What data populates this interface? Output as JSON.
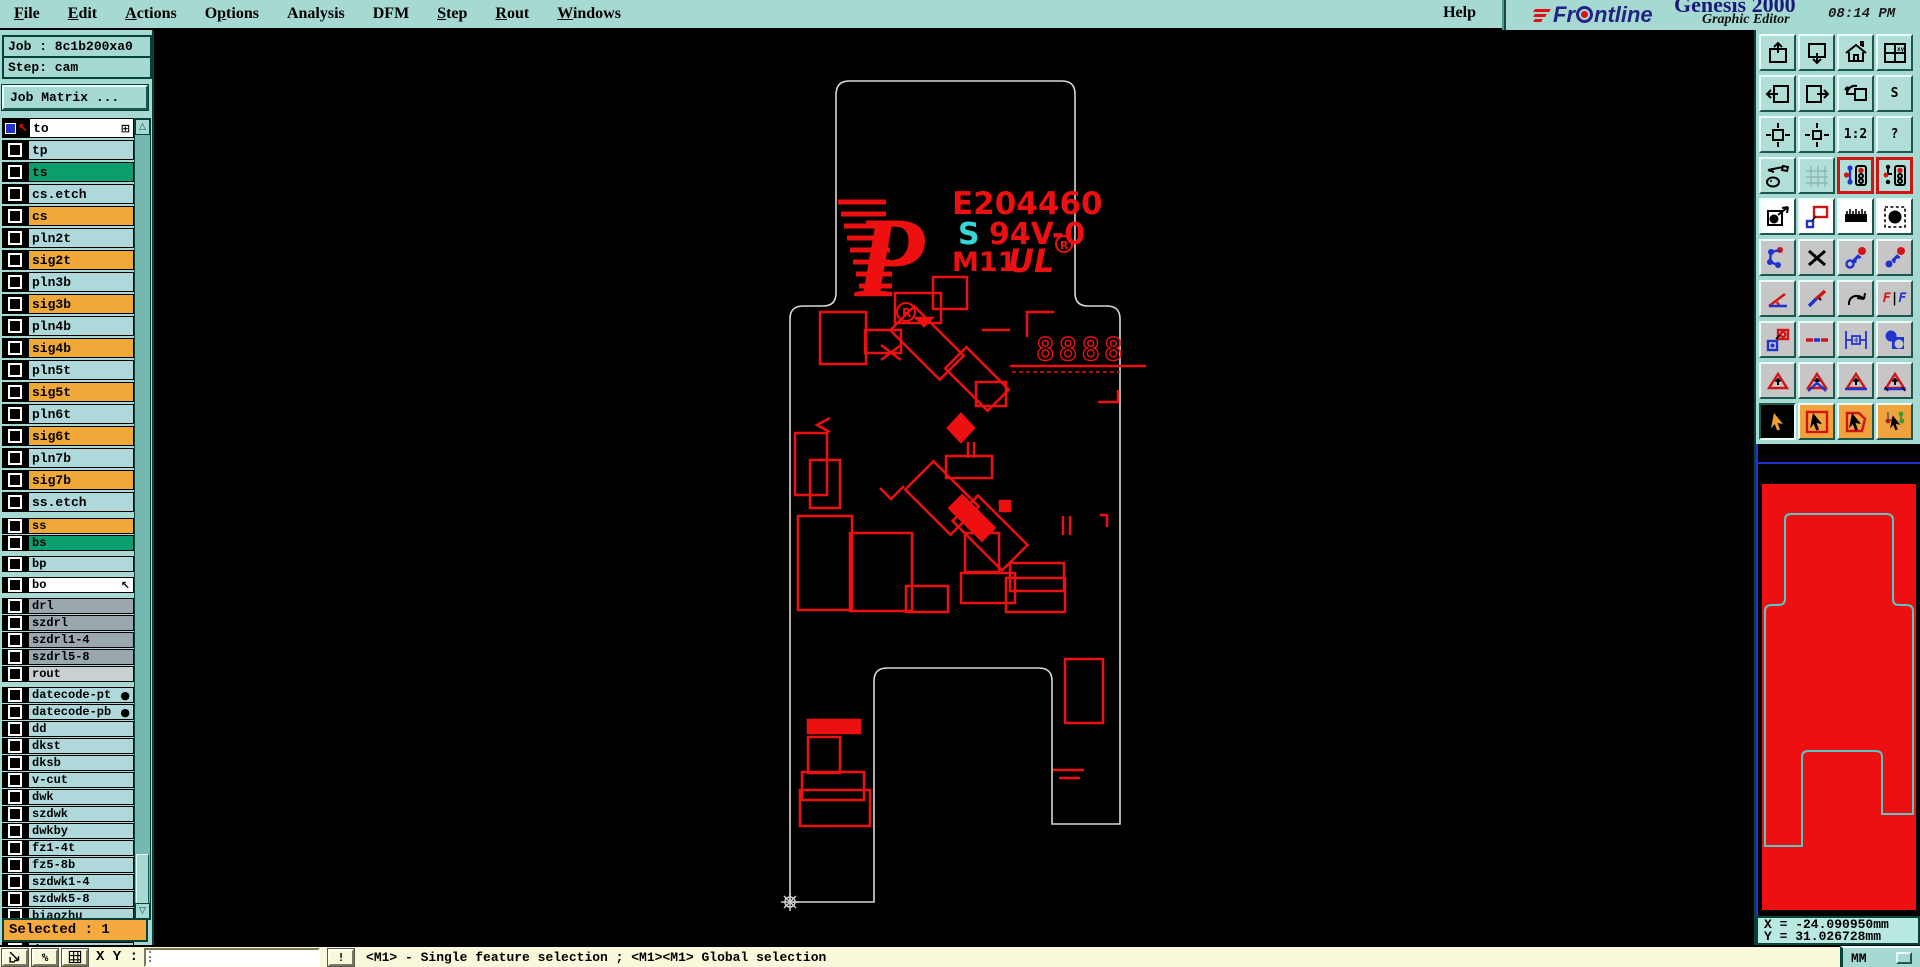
{
  "menubar": {
    "items": [
      {
        "label": "File",
        "u": 0
      },
      {
        "label": "Edit",
        "u": 0
      },
      {
        "label": "Actions",
        "u": 0
      },
      {
        "label": "Options",
        "u": 1
      },
      {
        "label": "Analysis",
        "u": -1
      },
      {
        "label": "DFM",
        "u": -1
      },
      {
        "label": "Step",
        "u": 0
      },
      {
        "label": "Rout",
        "u": 0
      },
      {
        "label": "Windows",
        "u": 0
      }
    ],
    "help": {
      "label": "Help",
      "u": -1
    }
  },
  "brand": {
    "logo_text": "Frontline",
    "product": "Genesis 2000",
    "subtitle": "Graphic Editor",
    "clock": "08:14 PM"
  },
  "sidebar": {
    "job_label": "Job : 8c1b200xa0",
    "step_label": "Step: cam",
    "job_matrix_button": "Job Matrix ...",
    "selected_label": "Selected : 1",
    "layers": [
      {
        "name": "to",
        "color": "white",
        "section": "main",
        "work": true
      },
      {
        "name": "tp",
        "color": "cyan",
        "section": "main"
      },
      {
        "name": "ts",
        "color": "green",
        "section": "main"
      },
      {
        "name": "cs.etch",
        "color": "cyan",
        "section": "main"
      },
      {
        "name": "cs",
        "color": "orange",
        "section": "main"
      },
      {
        "name": "pln2t",
        "color": "cyan",
        "section": "main"
      },
      {
        "name": "sig2t",
        "color": "orange",
        "section": "main"
      },
      {
        "name": "pln3b",
        "color": "cyan",
        "section": "main"
      },
      {
        "name": "sig3b",
        "color": "orange",
        "section": "main"
      },
      {
        "name": "pln4b",
        "color": "cyan",
        "section": "main"
      },
      {
        "name": "sig4b",
        "color": "orange",
        "section": "main"
      },
      {
        "name": "pln5t",
        "color": "cyan",
        "section": "main"
      },
      {
        "name": "sig5t",
        "color": "orange",
        "section": "main"
      },
      {
        "name": "pln6t",
        "color": "cyan",
        "section": "main"
      },
      {
        "name": "sig6t",
        "color": "orange",
        "section": "main"
      },
      {
        "name": "pln7b",
        "color": "cyan",
        "section": "main"
      },
      {
        "name": "sig7b",
        "color": "orange",
        "section": "main"
      },
      {
        "name": "ss.etch",
        "color": "cyan",
        "section": "main"
      },
      {
        "name": "ss",
        "color": "orange",
        "section": "s2"
      },
      {
        "name": "bs",
        "color": "green",
        "section": "s2"
      },
      {
        "name": "bp",
        "color": "cyan",
        "section": "s3"
      },
      {
        "name": "bo",
        "color": "white",
        "section": "s4",
        "pointer": true
      },
      {
        "name": "drl",
        "color": "gray",
        "section": "s5"
      },
      {
        "name": "szdrl",
        "color": "gray",
        "section": "s5"
      },
      {
        "name": "szdrl1-4",
        "color": "gray",
        "section": "s5"
      },
      {
        "name": "szdrl5-8",
        "color": "gray",
        "section": "s5"
      },
      {
        "name": "rout",
        "color": "lightgray",
        "section": "s5"
      },
      {
        "name": "datecode-pt",
        "color": "cyan",
        "section": "s6",
        "truncated": true
      },
      {
        "name": "datecode-pb",
        "color": "cyan",
        "section": "s6",
        "truncated": true
      },
      {
        "name": "dd",
        "color": "cyan",
        "section": "s6"
      },
      {
        "name": "dkst",
        "color": "cyan",
        "section": "s6"
      },
      {
        "name": "dksb",
        "color": "cyan",
        "section": "s6"
      },
      {
        "name": "v-cut",
        "color": "cyan",
        "section": "s6"
      },
      {
        "name": "dwk",
        "color": "cyan",
        "section": "s6"
      },
      {
        "name": "szdwk",
        "color": "cyan",
        "section": "s6"
      },
      {
        "name": "dwkby",
        "color": "cyan",
        "section": "s6"
      },
      {
        "name": "fz1-4t",
        "color": "cyan",
        "section": "s6"
      },
      {
        "name": "fz5-8b",
        "color": "cyan",
        "section": "s6"
      },
      {
        "name": "szdwk1-4",
        "color": "cyan",
        "section": "s6"
      },
      {
        "name": "szdwk5-8",
        "color": "cyan",
        "section": "s6"
      },
      {
        "name": "biaozhu",
        "color": "cyan",
        "section": "s6"
      },
      {
        "name": "d",
        "color": "cyan",
        "section": "s6"
      },
      {
        "name": "d1-4",
        "color": "cyan",
        "section": "s6"
      }
    ]
  },
  "canvas": {
    "board": {
      "ul_number": "E204460",
      "flam_s": "S",
      "flam_rating": "94V-0",
      "date_code": "M11",
      "digits": "8888"
    }
  },
  "toolbox": {
    "rows": [
      [
        {
          "name": "view-box-up"
        },
        {
          "name": "view-box-down"
        },
        {
          "name": "home-view"
        },
        {
          "name": "window-xy"
        }
      ],
      [
        {
          "name": "view-box-left"
        },
        {
          "name": "view-box-right"
        },
        {
          "name": "previous-view"
        },
        {
          "name": "s-shape",
          "label": "S"
        }
      ],
      [
        {
          "name": "expand-view"
        },
        {
          "name": "shrink-view"
        },
        {
          "name": "zoom-ratio",
          "label": "1:2"
        },
        {
          "name": "help-question",
          "label": "?"
        }
      ],
      [
        {
          "name": "draw-tools"
        },
        {
          "name": "grid-toggle"
        },
        {
          "name": "net-highlight-a"
        },
        {
          "name": "net-highlight-b"
        }
      ],
      [
        {
          "name": "select-feature"
        },
        {
          "name": "measure-objects"
        },
        {
          "name": "ruler-measure"
        },
        {
          "name": "pad-marquee"
        }
      ],
      [
        {
          "name": "net-points"
        },
        {
          "name": "delete-x"
        },
        {
          "name": "open-to-pad"
        },
        {
          "name": "pad-to-pad"
        }
      ],
      [
        {
          "name": "angle-measure"
        },
        {
          "name": "diagonal-line"
        },
        {
          "name": "arc-tool"
        },
        {
          "name": "mirror-ff"
        }
      ],
      [
        {
          "name": "pad-copy"
        },
        {
          "name": "dashed-line"
        },
        {
          "name": "width-measure"
        },
        {
          "name": "touching-pads"
        }
      ],
      [
        {
          "name": "triangle-a"
        },
        {
          "name": "triangle-b"
        },
        {
          "name": "triangle-c"
        },
        {
          "name": "triangle-d"
        }
      ],
      [
        {
          "name": "cursor-select"
        },
        {
          "name": "cursor-frame"
        },
        {
          "name": "cursor-polygon"
        },
        {
          "name": "cursor-net"
        }
      ]
    ]
  },
  "coords_readout": {
    "x": "X = -24.090950mm",
    "y": "Y = 31.026728mm"
  },
  "statusbar": {
    "xy_label": "X Y :",
    "input_value": "",
    "status": "<M1> - Single feature selection ; <M1><M1> Global selection",
    "units": "MM"
  }
}
